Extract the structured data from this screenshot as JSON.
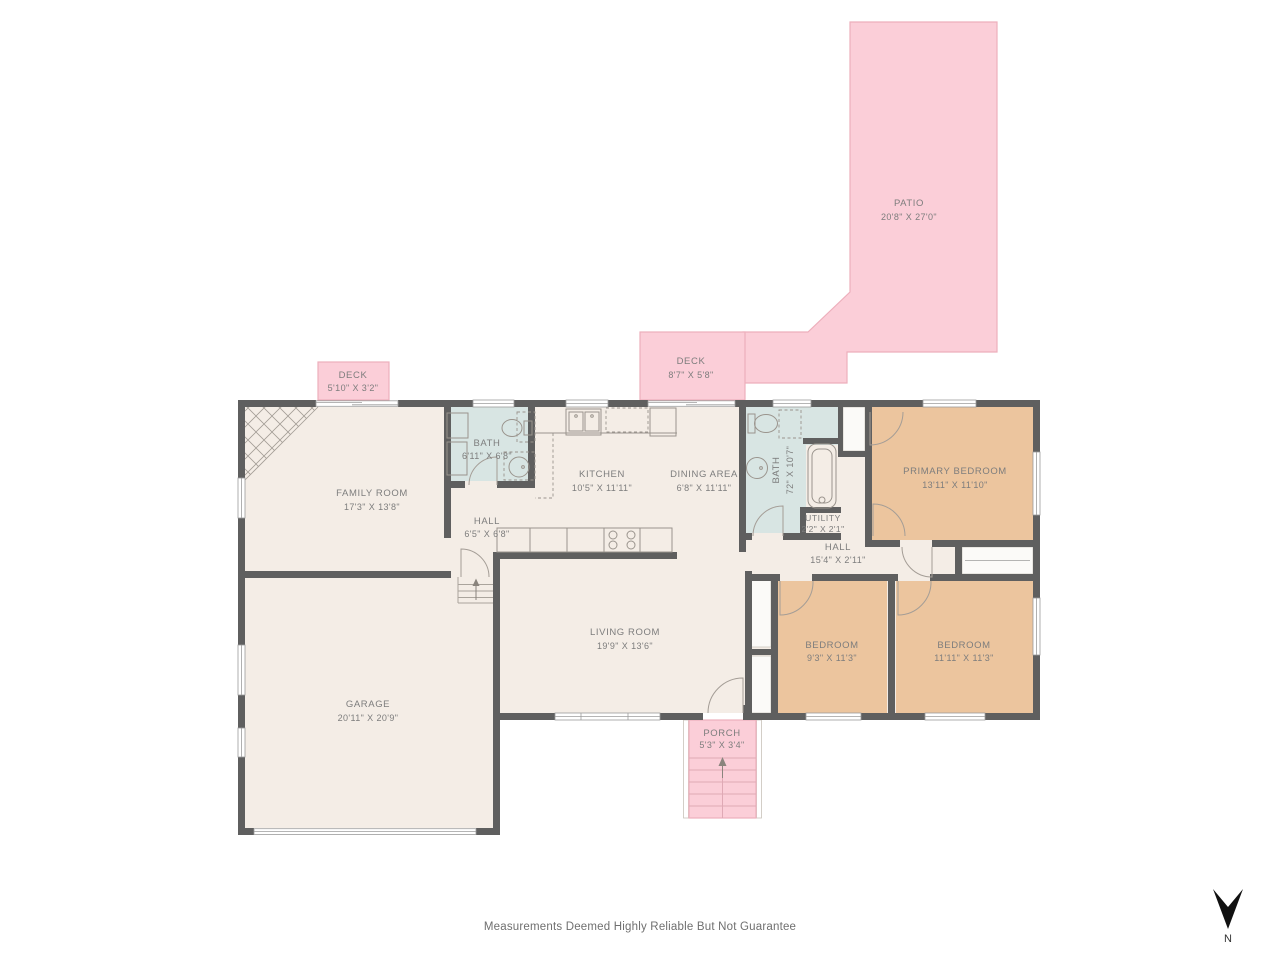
{
  "colors": {
    "background": "#ffffff",
    "wall": "#5f5f5f",
    "floor": "#f4ede6",
    "bath-blue": "#d8e5e3",
    "bedroom-tan": "#ecc59e",
    "outdoor-pink": "#fbced8",
    "outdoor-pink-border": "#edafbc",
    "porch-step-line": "#dfa9b5",
    "closet-white": "#fbfaf8",
    "label-text": "#7d7d7d",
    "fixture-line": "#9a948d",
    "window-line": "#9c9c9c",
    "footer-text": "#6f6f6f",
    "compass-black": "#111111"
  },
  "rooms": {
    "patio": {
      "name": "PATIO",
      "dims": "20'8\" X 27'0\""
    },
    "deck_right": {
      "name": "DECK",
      "dims": "8'7\" X 5'8\""
    },
    "deck_left": {
      "name": "DECK",
      "dims": "5'10\" X 3'2\""
    },
    "family_room": {
      "name": "FAMILY ROOM",
      "dims": "17'3\" X 13'8\""
    },
    "bath_main": {
      "name": "BATH",
      "dims": "6'11\" X 6'8\""
    },
    "hall_front": {
      "name": "HALL",
      "dims": "6'5\" X 6'8\""
    },
    "kitchen": {
      "name": "KITCHEN",
      "dims": "10'5\" X 11'11\""
    },
    "dining_area": {
      "name": "DINING AREA",
      "dims": "6'8\" X 11'11\""
    },
    "bath_primary": {
      "name": "BATH",
      "dims": "72\" X 10'7\""
    },
    "utility": {
      "name": "UTILITY",
      "dims": "2'2\" X 2'1\""
    },
    "hall_bedrooms": {
      "name": "HALL",
      "dims": "15'4\" X 2'11\""
    },
    "primary_bedroom": {
      "name": "PRIMARY BEDROOM",
      "dims": "13'11\" X 11'10\""
    },
    "living_room": {
      "name": "LIVING ROOM",
      "dims": "19'9\" X 13'6\""
    },
    "garage": {
      "name": "GARAGE",
      "dims": "20'11\" X 20'9\""
    },
    "bedroom_left": {
      "name": "BEDROOM",
      "dims": "9'3\" X 11'3\""
    },
    "bedroom_right": {
      "name": "BEDROOM",
      "dims": "11'11\" X 11'3\""
    },
    "porch": {
      "name": "PORCH",
      "dims": "5'3\" X 3'4\""
    }
  },
  "compass": {
    "label": "N"
  },
  "footer": {
    "disclaimer": "Measurements Deemed Highly Reliable But Not Guarantee"
  }
}
